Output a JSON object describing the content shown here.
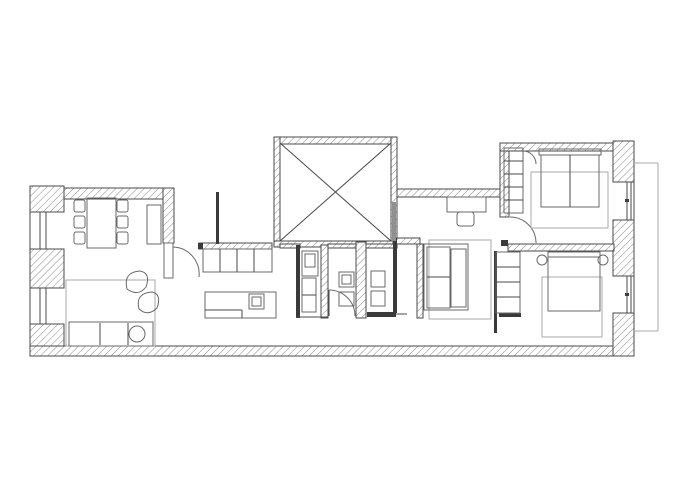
{
  "canvas": {
    "width": 700,
    "height": 500,
    "background": "#ffffff"
  },
  "colors": {
    "wall_stroke": "#4a4a4a",
    "hatch_line": "#8a8a8a",
    "furniture_stroke": "#6a6a6a",
    "light_stroke": "#a8a8a8",
    "dark_fill": "#3a3a3a",
    "gray_fill": "#909090"
  },
  "elements": [
    {
      "k": "h",
      "n": "wall-living-top",
      "b": [
        30,
        188,
        144,
        11
      ]
    },
    {
      "k": "h",
      "n": "wall-top-left-corner",
      "b": [
        30,
        186,
        34,
        26
      ]
    },
    {
      "k": "h",
      "n": "pier-left-middle",
      "b": [
        30,
        249,
        34,
        39
      ]
    },
    {
      "k": "h",
      "n": "pier-left-bottom",
      "b": [
        30,
        324,
        34,
        31
      ]
    },
    {
      "k": "h",
      "n": "wall-bottom",
      "b": [
        30,
        346,
        604,
        10
      ]
    },
    {
      "k": "h",
      "n": "wall-living-right",
      "b": [
        163,
        188,
        11,
        55
      ]
    },
    {
      "k": "h",
      "n": "shaft-wall-top",
      "b": [
        274,
        137,
        123,
        7
      ]
    },
    {
      "k": "h",
      "n": "shaft-wall-left",
      "b": [
        274,
        137,
        6,
        110
      ]
    },
    {
      "k": "h",
      "n": "shaft-wall-right",
      "b": [
        391,
        137,
        6,
        110
      ]
    },
    {
      "k": "h",
      "n": "shaft-wall-bottom",
      "b": [
        274,
        241,
        123,
        6
      ]
    },
    {
      "k": "h",
      "n": "wall-bath-top-left",
      "b": [
        280,
        244,
        20,
        4
      ]
    },
    {
      "k": "h",
      "n": "wall-bath-top-right",
      "b": [
        328,
        244,
        69,
        4
      ]
    },
    {
      "k": "h",
      "n": "wall-hall-top",
      "b": [
        397,
        189,
        105,
        8
      ]
    },
    {
      "k": "h",
      "n": "wall-bedroom1-left",
      "b": [
        500,
        143,
        9,
        74
      ]
    },
    {
      "k": "h",
      "n": "wall-bedroom1-top",
      "b": [
        500,
        143,
        114,
        8
      ]
    },
    {
      "k": "h",
      "n": "pier-right-top",
      "b": [
        613,
        141,
        21,
        41
      ]
    },
    {
      "k": "h",
      "n": "pier-right-middle",
      "b": [
        613,
        220,
        21,
        56
      ]
    },
    {
      "k": "h",
      "n": "pier-right-bottom",
      "b": [
        613,
        313,
        21,
        43
      ]
    },
    {
      "k": "h",
      "n": "wall-bedrooms-partition",
      "b": [
        508,
        244,
        106,
        7
      ]
    },
    {
      "k": "h",
      "n": "wall-midroom-top",
      "b": [
        393,
        238,
        27,
        6
      ]
    },
    {
      "k": "h",
      "n": "wall-midroom-left",
      "b": [
        417,
        244,
        6,
        74
      ]
    },
    {
      "k": "h",
      "n": "wall-bath-a",
      "b": [
        321,
        245,
        7,
        73
      ]
    },
    {
      "k": "h",
      "n": "wall-bath-b",
      "b": [
        356,
        242,
        10,
        76
      ]
    },
    {
      "k": "h",
      "n": "counter-top-strip",
      "b": [
        199,
        243,
        73,
        6
      ]
    },
    {
      "k": "d",
      "n": "wall-bath-left-solid",
      "b": [
        296,
        245,
        4,
        73
      ]
    },
    {
      "k": "d",
      "n": "wall-bath-right-solid",
      "b": [
        393,
        238,
        4,
        75
      ]
    },
    {
      "k": "d",
      "n": "sliding-door-bath",
      "b": [
        367,
        312,
        29,
        5
      ]
    },
    {
      "k": "d",
      "n": "door-leaf-bedroom1",
      "b": [
        501,
        240,
        7,
        6
      ]
    },
    {
      "k": "d",
      "n": "wardrobe-bar-bedroom2",
      "b": [
        499,
        313,
        22,
        4
      ]
    },
    {
      "k": "d",
      "n": "kitchen-partition",
      "b": [
        216,
        192,
        3,
        52
      ]
    },
    {
      "k": "d",
      "n": "counter-end-cap",
      "b": [
        198,
        243,
        5,
        6
      ]
    },
    {
      "k": "d",
      "n": "wall-bedroom2-left",
      "b": [
        494,
        251,
        3,
        82
      ]
    },
    {
      "k": "d",
      "n": "window-pivot-top",
      "b": [
        625,
        199,
        4,
        3
      ]
    },
    {
      "k": "d",
      "n": "window-pivot-bottom",
      "b": [
        625,
        293,
        4,
        3
      ]
    },
    {
      "k": "g",
      "n": "shaft-duct",
      "b": [
        392,
        202,
        4,
        39
      ]
    },
    {
      "k": "l",
      "n": "outer-left-edge",
      "p": [
        30,
        186,
        30,
        356
      ]
    },
    {
      "k": "l",
      "n": "window-left-1a",
      "p": [
        40,
        212,
        40,
        249
      ]
    },
    {
      "k": "l",
      "n": "window-left-1b",
      "p": [
        46,
        212,
        46,
        249
      ]
    },
    {
      "k": "l",
      "n": "window-left-2a",
      "p": [
        40,
        288,
        40,
        324
      ]
    },
    {
      "k": "l",
      "n": "window-left-2b",
      "p": [
        46,
        288,
        46,
        324
      ]
    },
    {
      "k": "l",
      "n": "outer-right-edge",
      "p": [
        634,
        141,
        634,
        356
      ]
    },
    {
      "k": "l",
      "n": "window-right-1a",
      "p": [
        627,
        182,
        627,
        220
      ]
    },
    {
      "k": "l",
      "n": "window-right-1b",
      "p": [
        631,
        182,
        631,
        220
      ]
    },
    {
      "k": "l",
      "n": "window-right-2a",
      "p": [
        627,
        276,
        627,
        313
      ]
    },
    {
      "k": "l",
      "n": "window-right-2b",
      "p": [
        631,
        276,
        631,
        313
      ]
    },
    {
      "k": "ll",
      "n": "balcony-outline-top",
      "p": [
        634,
        163,
        658,
        163
      ]
    },
    {
      "k": "ll",
      "n": "balcony-outline-right",
      "p": [
        658,
        163,
        658,
        331
      ]
    },
    {
      "k": "ll",
      "n": "balcony-outline-bottom",
      "p": [
        634,
        331,
        658,
        331
      ]
    },
    {
      "k": "l",
      "n": "shaft-diagonal-1",
      "p": [
        280,
        143,
        391,
        241
      ]
    },
    {
      "k": "l",
      "n": "shaft-diagonal-2",
      "p": [
        391,
        143,
        280,
        241
      ]
    },
    {
      "k": "l",
      "n": "sliding-door-track",
      "p": [
        396,
        314,
        407,
        314
      ]
    },
    {
      "k": "l",
      "n": "bath-left-bottom-edge",
      "p": [
        296,
        317,
        328,
        317
      ]
    },
    {
      "k": "l",
      "n": "door-leaf-bath",
      "p": [
        329,
        290,
        329,
        316
      ]
    },
    {
      "k": "r",
      "n": "door-leaf-living",
      "b": [
        164,
        243,
        9,
        35
      ]
    },
    {
      "k": "p",
      "n": "door-arc-living",
      "d": "M 173,247 A 27 27 0 0 1 199,277"
    },
    {
      "k": "p",
      "n": "door-arc-bath",
      "d": "M 329,290 A 26 26 0 0 1 355,316"
    },
    {
      "k": "p",
      "n": "door-arc-bedroom1",
      "d": "M 510,217 A 26 26 0 0 1 536,243"
    },
    {
      "k": "p",
      "n": "closet-arc-bedroom1",
      "d": "M 523,151 A 13 13 0 0 1 536,164"
    },
    {
      "k": "r",
      "n": "dining-table",
      "b": [
        87,
        198,
        29,
        50
      ]
    },
    {
      "k": "r",
      "n": "dining-chair",
      "b": [
        74,
        200,
        11,
        12
      ],
      "rx": 2
    },
    {
      "k": "r",
      "n": "dining-chair",
      "b": [
        74,
        216,
        11,
        12
      ],
      "rx": 2
    },
    {
      "k": "r",
      "n": "dining-chair",
      "b": [
        74,
        232,
        11,
        12
      ],
      "rx": 2
    },
    {
      "k": "r",
      "n": "dining-chair",
      "b": [
        117,
        200,
        11,
        12
      ],
      "rx": 2
    },
    {
      "k": "r",
      "n": "dining-chair",
      "b": [
        117,
        216,
        11,
        12
      ],
      "rx": 2
    },
    {
      "k": "r",
      "n": "dining-chair",
      "b": [
        117,
        232,
        11,
        12
      ],
      "rx": 2
    },
    {
      "k": "r",
      "n": "sideboard",
      "b": [
        147,
        205,
        14,
        39
      ]
    },
    {
      "k": "lr",
      "n": "rug-living",
      "b": [
        66,
        280,
        89,
        66
      ]
    },
    {
      "k": "r",
      "n": "sofa",
      "b": [
        69,
        322,
        84,
        24
      ]
    },
    {
      "k": "l",
      "n": "sofa-seat-line-1",
      "p": [
        100,
        323,
        100,
        345
      ]
    },
    {
      "k": "l",
      "n": "sofa-seat-line-2",
      "p": [
        128,
        323,
        128,
        345
      ]
    },
    {
      "k": "c",
      "n": "sofa-side-table",
      "c": [
        137,
        334,
        8
      ]
    },
    {
      "k": "p",
      "n": "armchair-1",
      "d": "M 127,289 Q 123,272 140,271 Q 151,273 146,287 Q 138,297 127,289 Z"
    },
    {
      "k": "p",
      "n": "armchair-2",
      "d": "M 139,309 Q 135,293 152,292 Q 162,294 157,308 Q 148,317 139,309 Z"
    },
    {
      "k": "r",
      "n": "kitchen-counter",
      "b": [
        203,
        249,
        69,
        23
      ]
    },
    {
      "k": "l",
      "n": "counter-div-1",
      "p": [
        220,
        249,
        220,
        272
      ]
    },
    {
      "k": "l",
      "n": "counter-div-2",
      "p": [
        237,
        249,
        237,
        272
      ]
    },
    {
      "k": "l",
      "n": "counter-div-3",
      "p": [
        254,
        249,
        254,
        272
      ]
    },
    {
      "k": "r",
      "n": "kitchen-island",
      "b": [
        205,
        292,
        71,
        26
      ]
    },
    {
      "k": "r",
      "n": "island-sink",
      "b": [
        249,
        294,
        15,
        15
      ]
    },
    {
      "k": "r",
      "n": "island-sink-inner",
      "b": [
        252,
        297,
        9,
        9
      ]
    },
    {
      "k": "l",
      "n": "island-line-h",
      "p": [
        205,
        310,
        242,
        310
      ]
    },
    {
      "k": "l",
      "n": "island-line-v",
      "p": [
        242,
        310,
        242,
        318
      ]
    },
    {
      "k": "r",
      "n": "toilet-1",
      "b": [
        302,
        251,
        16,
        25
      ]
    },
    {
      "k": "r",
      "n": "toilet-1-tank",
      "b": [
        305,
        254,
        10,
        13
      ]
    },
    {
      "k": "r",
      "n": "bath-cabinet",
      "b": [
        302,
        278,
        14,
        34
      ]
    },
    {
      "k": "l",
      "n": "bath-cabinet-div",
      "p": [
        302,
        295,
        316,
        295
      ]
    },
    {
      "k": "r",
      "n": "sink-2",
      "b": [
        339,
        272,
        15,
        15
      ]
    },
    {
      "k": "r",
      "n": "sink-2-inner",
      "b": [
        342,
        275,
        9,
        9
      ]
    },
    {
      "k": "r",
      "n": "toilet-2",
      "b": [
        339,
        292,
        15,
        14
      ]
    },
    {
      "k": "r",
      "n": "sink-3",
      "b": [
        371,
        271,
        14,
        16
      ]
    },
    {
      "k": "r",
      "n": "toilet-3",
      "b": [
        371,
        291,
        14,
        15
      ]
    },
    {
      "k": "r",
      "n": "hall-desk",
      "b": [
        447,
        197,
        39,
        15
      ]
    },
    {
      "k": "r",
      "n": "hall-desk-chair",
      "b": [
        457,
        212,
        17,
        14
      ],
      "rx": 3
    },
    {
      "k": "lr",
      "n": "rug-midroom",
      "b": [
        429,
        240,
        62,
        79
      ]
    },
    {
      "k": "r",
      "n": "bed-mid-frame",
      "b": [
        424,
        244,
        44,
        66
      ]
    },
    {
      "k": "r",
      "n": "bed-mid-mattress",
      "b": [
        427,
        247,
        23,
        61
      ]
    },
    {
      "k": "l",
      "n": "bed-mid-fold",
      "p": [
        427,
        277,
        450,
        277
      ]
    },
    {
      "k": "r",
      "n": "bed-mid-side",
      "b": [
        451,
        249,
        15,
        58
      ]
    },
    {
      "k": "r",
      "n": "wardrobe-bedroom1",
      "b": [
        504,
        148,
        19,
        65
      ]
    },
    {
      "k": "l",
      "n": "wardrobe-b1-div1",
      "p": [
        504,
        161,
        523,
        161
      ]
    },
    {
      "k": "l",
      "n": "wardrobe-b1-div2",
      "p": [
        504,
        174,
        523,
        174
      ]
    },
    {
      "k": "l",
      "n": "wardrobe-b1-div3",
      "p": [
        504,
        187,
        523,
        187
      ]
    },
    {
      "k": "l",
      "n": "wardrobe-b1-div4",
      "p": [
        504,
        200,
        523,
        200
      ]
    },
    {
      "k": "lr",
      "n": "rug-bedroom1",
      "b": [
        531,
        172,
        77,
        56
      ]
    },
    {
      "k": "r",
      "n": "bed-bedroom1-headboard",
      "b": [
        539,
        149,
        62,
        6
      ]
    },
    {
      "k": "r",
      "n": "bed-bedroom1",
      "b": [
        541,
        155,
        58,
        52
      ]
    },
    {
      "k": "l",
      "n": "bed-bedroom1-center",
      "p": [
        570,
        155,
        570,
        207
      ]
    },
    {
      "k": "r",
      "n": "wardrobe-bedroom2",
      "b": [
        496,
        252,
        24,
        61
      ]
    },
    {
      "k": "l",
      "n": "wardrobe-b2-div1",
      "p": [
        496,
        267,
        520,
        267
      ]
    },
    {
      "k": "l",
      "n": "wardrobe-b2-div2",
      "p": [
        496,
        282,
        520,
        282
      ]
    },
    {
      "k": "l",
      "n": "wardrobe-b2-div3",
      "p": [
        496,
        297,
        520,
        297
      ]
    },
    {
      "k": "lr",
      "n": "rug-bedroom2",
      "b": [
        542,
        277,
        60,
        60
      ]
    },
    {
      "k": "r",
      "n": "bed-bedroom2-headboard",
      "b": [
        548,
        252,
        52,
        5
      ]
    },
    {
      "k": "r",
      "n": "bed-bedroom2",
      "b": [
        548,
        257,
        52,
        54
      ]
    },
    {
      "k": "c",
      "n": "nightstand-left",
      "c": [
        542,
        260,
        5
      ]
    },
    {
      "k": "c",
      "n": "nightstand-right",
      "c": [
        603,
        260,
        5
      ]
    }
  ]
}
